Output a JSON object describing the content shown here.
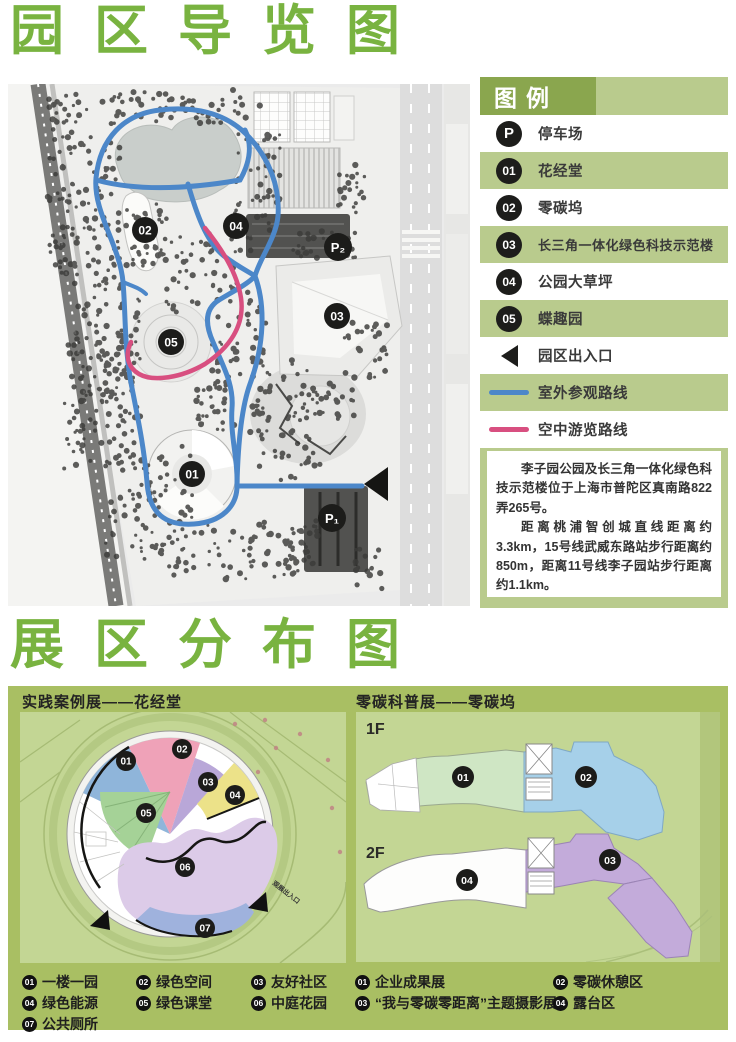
{
  "titles": {
    "main": "园区导览图",
    "secondary": "展区分布图"
  },
  "legend": {
    "header": "图例",
    "icon_texts": {
      "parking": "P",
      "n01": "01",
      "n02": "02",
      "n03": "03",
      "n04": "04",
      "n05": "05"
    },
    "items": [
      {
        "label": "停车场"
      },
      {
        "label": "花经堂"
      },
      {
        "label": "零碳坞"
      },
      {
        "label": "长三角一体化绿色科技示范楼"
      },
      {
        "label": "公园大草坪"
      },
      {
        "label": "蝶趣园"
      },
      {
        "label": "园区出入口"
      },
      {
        "label": "室外参观路线"
      },
      {
        "label": "空中游览路线"
      }
    ],
    "paragraphs": {
      "p1": "李子园公园及长三角一体化绿色科技示范楼位于上海市普陀区真南路822弄265号。",
      "p2": "距离桃浦智创城直线距离约3.3km，15号线武威东路站步行距离约850m，距离11号线李子园站步行距离约1.1km。"
    }
  },
  "park_map": {
    "markers": {
      "m01": "01",
      "m02": "02",
      "m03": "03",
      "m04": "04",
      "m05": "05",
      "p1": "P₁",
      "p2": "P₂"
    }
  },
  "sections": {
    "left": {
      "header": "实践案例展——花经堂",
      "entrance_label": "观展出入口",
      "map_markers": {
        "m01": "01",
        "m02": "02",
        "m03": "03",
        "m04": "04",
        "m05": "05",
        "m06": "06",
        "m07": "07"
      },
      "legend": [
        {
          "num": "01",
          "label": "一楼一园"
        },
        {
          "num": "02",
          "label": "绿色空间"
        },
        {
          "num": "03",
          "label": "友好社区"
        },
        {
          "num": "04",
          "label": "绿色能源"
        },
        {
          "num": "05",
          "label": "绿色课堂"
        },
        {
          "num": "06",
          "label": "中庭花园"
        },
        {
          "num": "07",
          "label": "公共厕所"
        }
      ]
    },
    "right": {
      "header": "零碳科普展——零碳坞",
      "floors": {
        "f1": "1F",
        "f2": "2F"
      },
      "map_markers": {
        "m01": "01",
        "m02": "02",
        "m03": "03",
        "m04": "04"
      },
      "legend": [
        {
          "num": "01",
          "label": "企业成果展"
        },
        {
          "num": "02",
          "label": "零碳休憩区"
        },
        {
          "num": "03",
          "label": "“我与零碳零距离”主题摄影展"
        },
        {
          "num": "04",
          "label": "露台区"
        }
      ]
    }
  },
  "colors": {
    "title_green": "#79b340",
    "legend_panel": "#b9cb8d",
    "legend_header": "#8aa64e",
    "bottom_panel": "#a9bf63",
    "route_blue": "#4c87c9",
    "route_pink": "#d84f80"
  }
}
